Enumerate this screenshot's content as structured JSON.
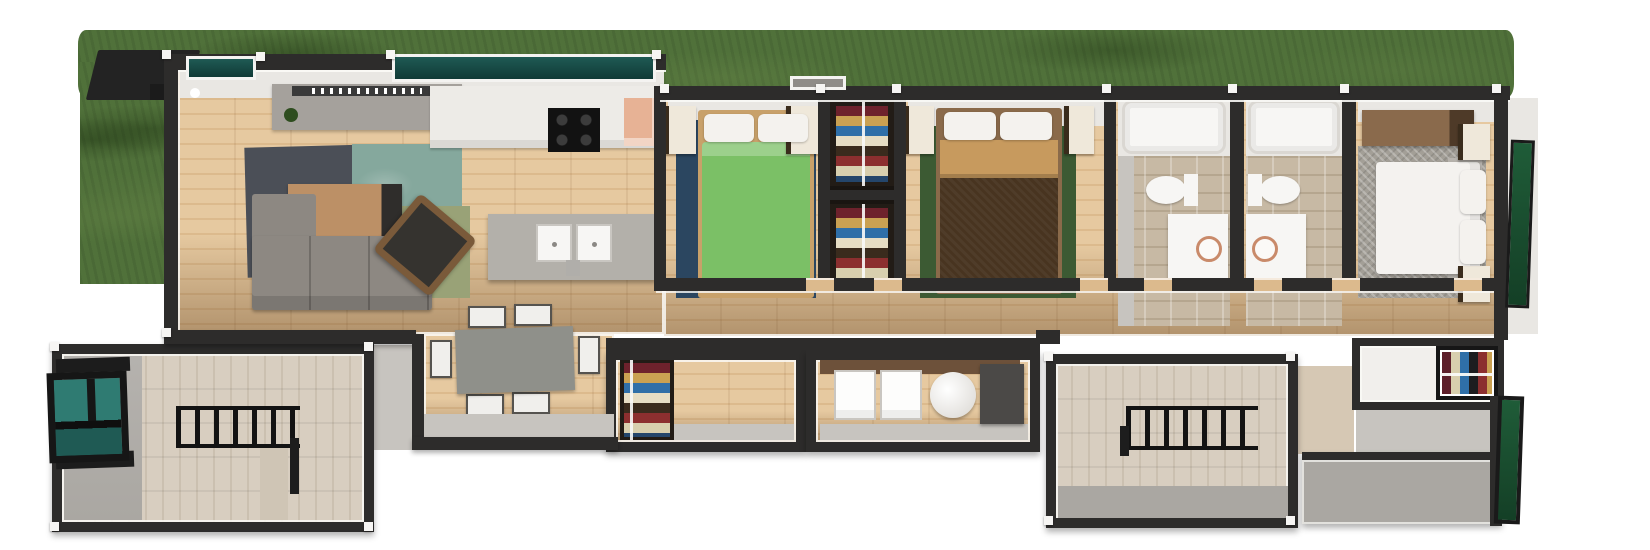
{
  "meta": {
    "description": "3D top-down architectural render of a long single-storey house with lawn, entry ramp, two pergola decks and five interior zones",
    "canvas": {
      "width": 1650,
      "height": 550
    }
  },
  "palette": {
    "bg": "#ffffff",
    "grass": "#50713a",
    "grass_dark": "#3f5c2c",
    "grass_light": "#5e7f45",
    "wall": "#2d2c2b",
    "wall_trim": "#f6f5f3",
    "wall_face": "#e9e7e3",
    "wall_face_gray": "#c7c4bf",
    "wood_a": "#e6c9a0",
    "wood_b": "#dcba8d",
    "wood_shadow": "#8a6a44",
    "deck_a": "#d8cec0",
    "deck_b": "#cbc0b0",
    "teal_glass": "#2f7b72",
    "teal_glass_dark": "#1f5a54",
    "green_glass": "#1f5c38",
    "green_glass_dark": "#143f26",
    "rug_slate": "#4b4f57",
    "rug_teal": "#85a89d",
    "rug_sage": "#99a277",
    "rug_navy": "#2b4660",
    "rug_forest": "#3c5a33",
    "rug_gray": "#a39f97",
    "sofa": "#8d8882",
    "ottoman": "#3c6a61",
    "coffee_table": "#bc9066",
    "armchair": "#35332f",
    "rattan": "#7a5a3a",
    "console": "#a5a19c",
    "counter": "#edebe7",
    "island": "#b3b0aa",
    "cooktop": "#121212",
    "pantry": "#e7b295",
    "bed_wood": "#c8a16a",
    "bed1_green": "#7bc066",
    "pillow": "#f4f2ee",
    "bed2_brown": "#483420",
    "bed2_tan": "#c79a5e",
    "bed_frame_dark": "#8a6a4a",
    "nightstand": "#efe8da",
    "dresser": "#8a6a4c",
    "mattress_white": "#f4f2ef",
    "tile": "#c7b9a4",
    "fixture": "#f7f6f4",
    "sink_rim": "#c98a6a",
    "table": "#8f908a",
    "chair_seat": "#f0efec",
    "appliance": "#fdfdfc",
    "appliance_dark": "#4b4947",
    "pergola": "#131313",
    "closet_bg": "#221c16",
    "walkway": "#908d89",
    "patio_gray": "#aaa7a2"
  },
  "stripes": {
    "folded_clothes": [
      "#6e222c",
      "#caa152",
      "#2f6fa8",
      "#e6ddc4",
      "#3a2b1d",
      "#8c2f2f",
      "#d8cfae",
      "#24466b"
    ],
    "hanging_clothes": [
      "#5e1f2a",
      "#d8cfae",
      "#2f6fa8",
      "#1d1d1f",
      "#8c2f2f",
      "#caa152"
    ]
  },
  "scene": {
    "exterior": {
      "lawn": "grass strip along the rear of the house",
      "entry": [
        "dark canopy roof",
        "stair railing",
        "grey walkway",
        "white door light",
        "teal glass sidelight"
      ],
      "glazing": [
        "teal entry window",
        "green glass master wall",
        "green glass patio wall"
      ]
    },
    "rooms": [
      {
        "id": "living",
        "label": "Living room",
        "furniture": [
          "tv-console",
          "plant",
          "slate-rug",
          "teal-rug",
          "sage-rug",
          "coffee-table",
          "sofa",
          "chaise",
          "round-ottoman",
          "rattan-armchair"
        ]
      },
      {
        "id": "kitchen",
        "label": "Kitchen",
        "furniture": [
          "wall-counter",
          "cooktop-4-burner",
          "pantry-corner",
          "island",
          "double-sink",
          "faucet"
        ]
      },
      {
        "id": "dining",
        "label": "Dining nook",
        "furniture": [
          "rectangular-table",
          "six-chairs"
        ]
      },
      {
        "id": "bedroom1",
        "label": "Bedroom 1",
        "furniture": [
          "green-double-bed",
          "navy-rug",
          "two-pillows",
          "two-nightstands"
        ]
      },
      {
        "id": "closets",
        "label": "Hall closets",
        "furniture": [
          "upper-wardrobe",
          "lower-wardrobe"
        ]
      },
      {
        "id": "bedroom2",
        "label": "Bedroom 2",
        "furniture": [
          "brown-double-bed",
          "tan-blanket",
          "forest-rug",
          "two-pillows",
          "two-nightstands"
        ]
      },
      {
        "id": "bathA",
        "label": "Bathroom A",
        "furniture": [
          "bathtub",
          "toilet",
          "vanity-with-sink"
        ]
      },
      {
        "id": "bathB",
        "label": "Bathroom B",
        "furniture": [
          "bathtub",
          "toilet",
          "vanity-with-sink"
        ]
      },
      {
        "id": "master",
        "label": "Master bedroom",
        "furniture": [
          "white-double-bed",
          "herringbone-rug",
          "dresser",
          "two-pillows",
          "two-nightstands"
        ]
      },
      {
        "id": "mcloset",
        "label": "Walk-in closet",
        "furniture": [
          "hanging-rail"
        ]
      },
      {
        "id": "linen",
        "label": "Storage room",
        "furniture": [
          "folded-clothes-shelf"
        ]
      },
      {
        "id": "laundry",
        "label": "Laundry",
        "furniture": [
          "washer",
          "dryer",
          "water-heater",
          "utility-cabinet"
        ]
      },
      {
        "id": "deckL",
        "label": "Left deck",
        "furniture": [
          "pergola",
          "teal-window",
          "privacy-stub"
        ]
      },
      {
        "id": "deckR",
        "label": "Right deck",
        "furniture": [
          "pergola",
          "grey-patio"
        ]
      }
    ]
  }
}
